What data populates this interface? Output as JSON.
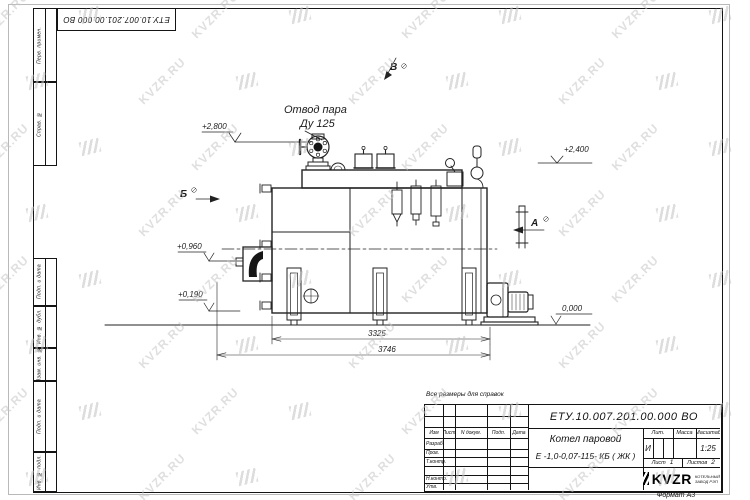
{
  "watermark": {
    "text": "KVZR.RU"
  },
  "side_fields": {
    "f1": "Перв. примен.",
    "f2": "Справ. №",
    "f3": "Подп. и дата",
    "f4": "Инв. № дубл.",
    "f5": "Взам. инв. №",
    "f6": "Подп. и дата",
    "f7": "Инв. № подл."
  },
  "drawing": {
    "labels": {
      "steam_outlet_line1": "Отвод пара",
      "steam_outlet_line2": "Ду 125",
      "view_a": "А",
      "view_b": "Б",
      "view_v": "В"
    },
    "elevations": {
      "e2800": "+2,800",
      "e2400": "+2,400",
      "e0960": "+0,960",
      "e0190": "+0,190",
      "e0000": "0,000"
    },
    "dimensions": {
      "d1": "3325",
      "d2": "3746"
    }
  },
  "title_block": {
    "note": "Все размеры для справок",
    "designation": "ЕТУ.10.007.201.00.000  ВО",
    "name_line1": "Котел паровой",
    "name_line2": "Е -1,0-0,07-115- КБ ( ЖК )",
    "columns": {
      "izm": "Изм",
      "list": "Лист",
      "ndok": "N докум.",
      "podp": "Подп.",
      "data": "Дата"
    },
    "rows": {
      "razrab": "Разраб.",
      "prov": "Пров.",
      "tkontr": "Т.контр.",
      "nkontr": "Н.контр.",
      "utv": "Утв."
    },
    "lit_label": "Лит.",
    "mass_label": "Масса",
    "scale_label": "Масштаб",
    "lit_value": "И",
    "scale_value": "1:25",
    "sheet_label": "Лист",
    "sheet_value": "1",
    "sheets_label": "Листов",
    "sheets_value": "2",
    "logo_text": "KVZR",
    "logo_sub1": "КОТЕЛЬНЫЙ",
    "logo_sub2": "ЗАВОД РЭП",
    "format": "Формат А3"
  }
}
